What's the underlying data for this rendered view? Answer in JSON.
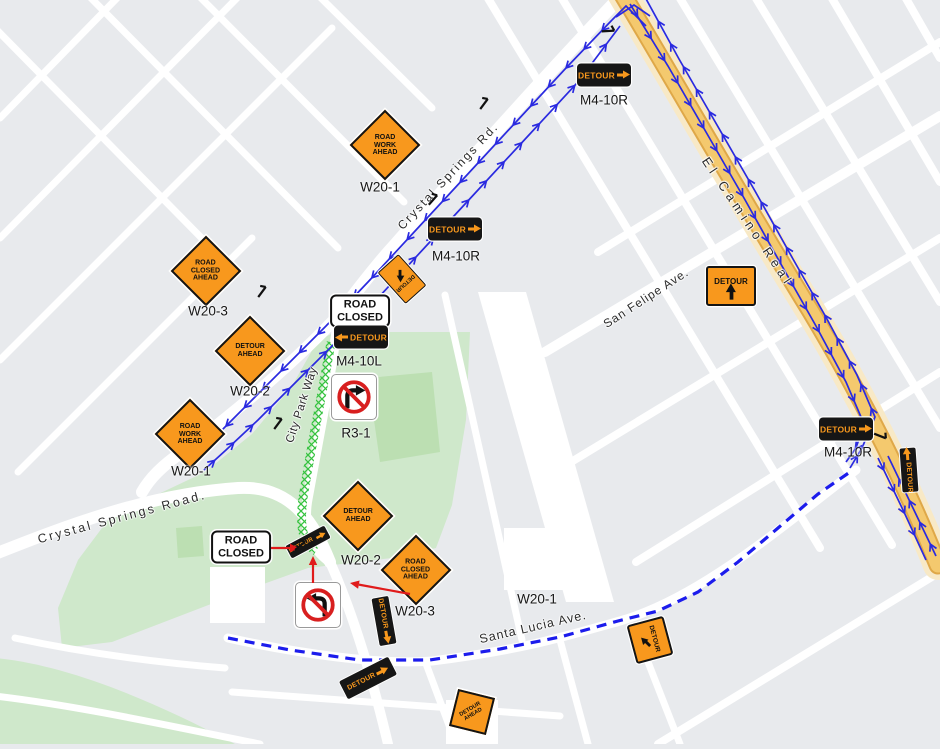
{
  "map": {
    "background": "#e8eaed",
    "colors": {
      "road": "#ffffff",
      "park_green": "#cfe8cb",
      "park_green_dark": "#bcdfb2",
      "el_camino_fill": "#f4c96e",
      "el_camino_edge": "#dfa848",
      "el_camino_halo": "#f8e9c6",
      "route_blue": "#2a2ae0",
      "dashed_route_blue": "#1c1cec",
      "closure_hatch_green": "#35c33f",
      "sign_orange": "#f8981d",
      "sign_black": "#161616",
      "annotation_red": "#e01b1b"
    },
    "streets": [
      {
        "id": "crystal-springs-rd",
        "name": "Crystal Springs Rd."
      },
      {
        "id": "el-camino-real",
        "name": "El Camino Real"
      },
      {
        "id": "san-felipe-ave",
        "name": "San Felipe Ave."
      },
      {
        "id": "santa-lucia-ave",
        "name": "Santa Lucia Ave."
      },
      {
        "id": "city-park-way",
        "name": "City Park Way"
      },
      {
        "id": "crystal-springs-road",
        "name": "Crystal Springs Road."
      }
    ]
  },
  "signs": [
    {
      "id": "d1",
      "type": "diamond",
      "lines": [
        "ROAD",
        "WORK",
        "AHEAD"
      ],
      "code": "W20-1"
    },
    {
      "id": "d2",
      "type": "diamond",
      "lines": [
        "ROAD",
        "CLOSED",
        "AHEAD"
      ],
      "code": "W20-3"
    },
    {
      "id": "d3",
      "type": "diamond",
      "lines": [
        "DETOUR",
        "AHEAD"
      ],
      "code": "W20-2"
    },
    {
      "id": "d4",
      "type": "diamond",
      "lines": [
        "ROAD",
        "WORK",
        "AHEAD"
      ],
      "code": "W20-1"
    },
    {
      "id": "d5",
      "type": "diamond",
      "lines": [
        "DETOUR",
        "AHEAD"
      ],
      "code": "W20-2"
    },
    {
      "id": "d6",
      "type": "diamond",
      "lines": [
        "ROAD",
        "CLOSED",
        "AHEAD"
      ],
      "code": "W20-3"
    },
    {
      "id": "d7",
      "type": "diamond",
      "lines": [
        "DETOUR",
        "AHEAD"
      ],
      "code": ""
    },
    {
      "id": "lblw201",
      "type": "code_label",
      "code": "W20-1"
    },
    {
      "id": "rc1",
      "type": "road_closed",
      "lines": [
        "ROAD",
        "CLOSED"
      ],
      "code": ""
    },
    {
      "id": "rc2",
      "type": "road_closed",
      "lines": [
        "ROAD",
        "CLOSED"
      ],
      "code": ""
    },
    {
      "id": "m1",
      "type": "detour_plate",
      "text": "DETOUR",
      "arrow": "right",
      "code": "M4-10R"
    },
    {
      "id": "m2",
      "type": "detour_plate",
      "text": "DETOUR",
      "arrow": "right",
      "code": "M4-10R"
    },
    {
      "id": "m3",
      "type": "detour_plate",
      "text": "DETOUR",
      "arrow": "left",
      "code": "M4-10L"
    },
    {
      "id": "m4",
      "type": "detour_plate",
      "text": "DETOUR",
      "arrow": "right",
      "code": "M4-10R"
    },
    {
      "id": "o1",
      "type": "detour_orange",
      "text": "DETOUR",
      "arrow": "up",
      "code": ""
    },
    {
      "id": "o2",
      "type": "detour_orange_small",
      "text": "DETOUR",
      "arrow": "up-left",
      "code": ""
    },
    {
      "id": "r1",
      "type": "roadside_detour_orange",
      "text": "DETOUR",
      "arrow": "down",
      "code": ""
    },
    {
      "id": "r2",
      "type": "roadside_detour_black",
      "text": "DETOUR",
      "arrow": "forward",
      "code": ""
    },
    {
      "id": "r3",
      "type": "roadside_detour_black",
      "text": "DETOUR",
      "arrow": "forward",
      "code": ""
    },
    {
      "id": "r4",
      "type": "roadside_detour_black",
      "text": "DETOUR",
      "arrow": "forward",
      "code": ""
    },
    {
      "id": "r5",
      "type": "roadside_detour_black",
      "text": "DETOUR",
      "arrow": "forward",
      "code": ""
    },
    {
      "id": "nr1",
      "type": "no_right_turn",
      "code": "R3-1"
    },
    {
      "id": "nl1",
      "type": "no_left_turn",
      "code": ""
    }
  ]
}
